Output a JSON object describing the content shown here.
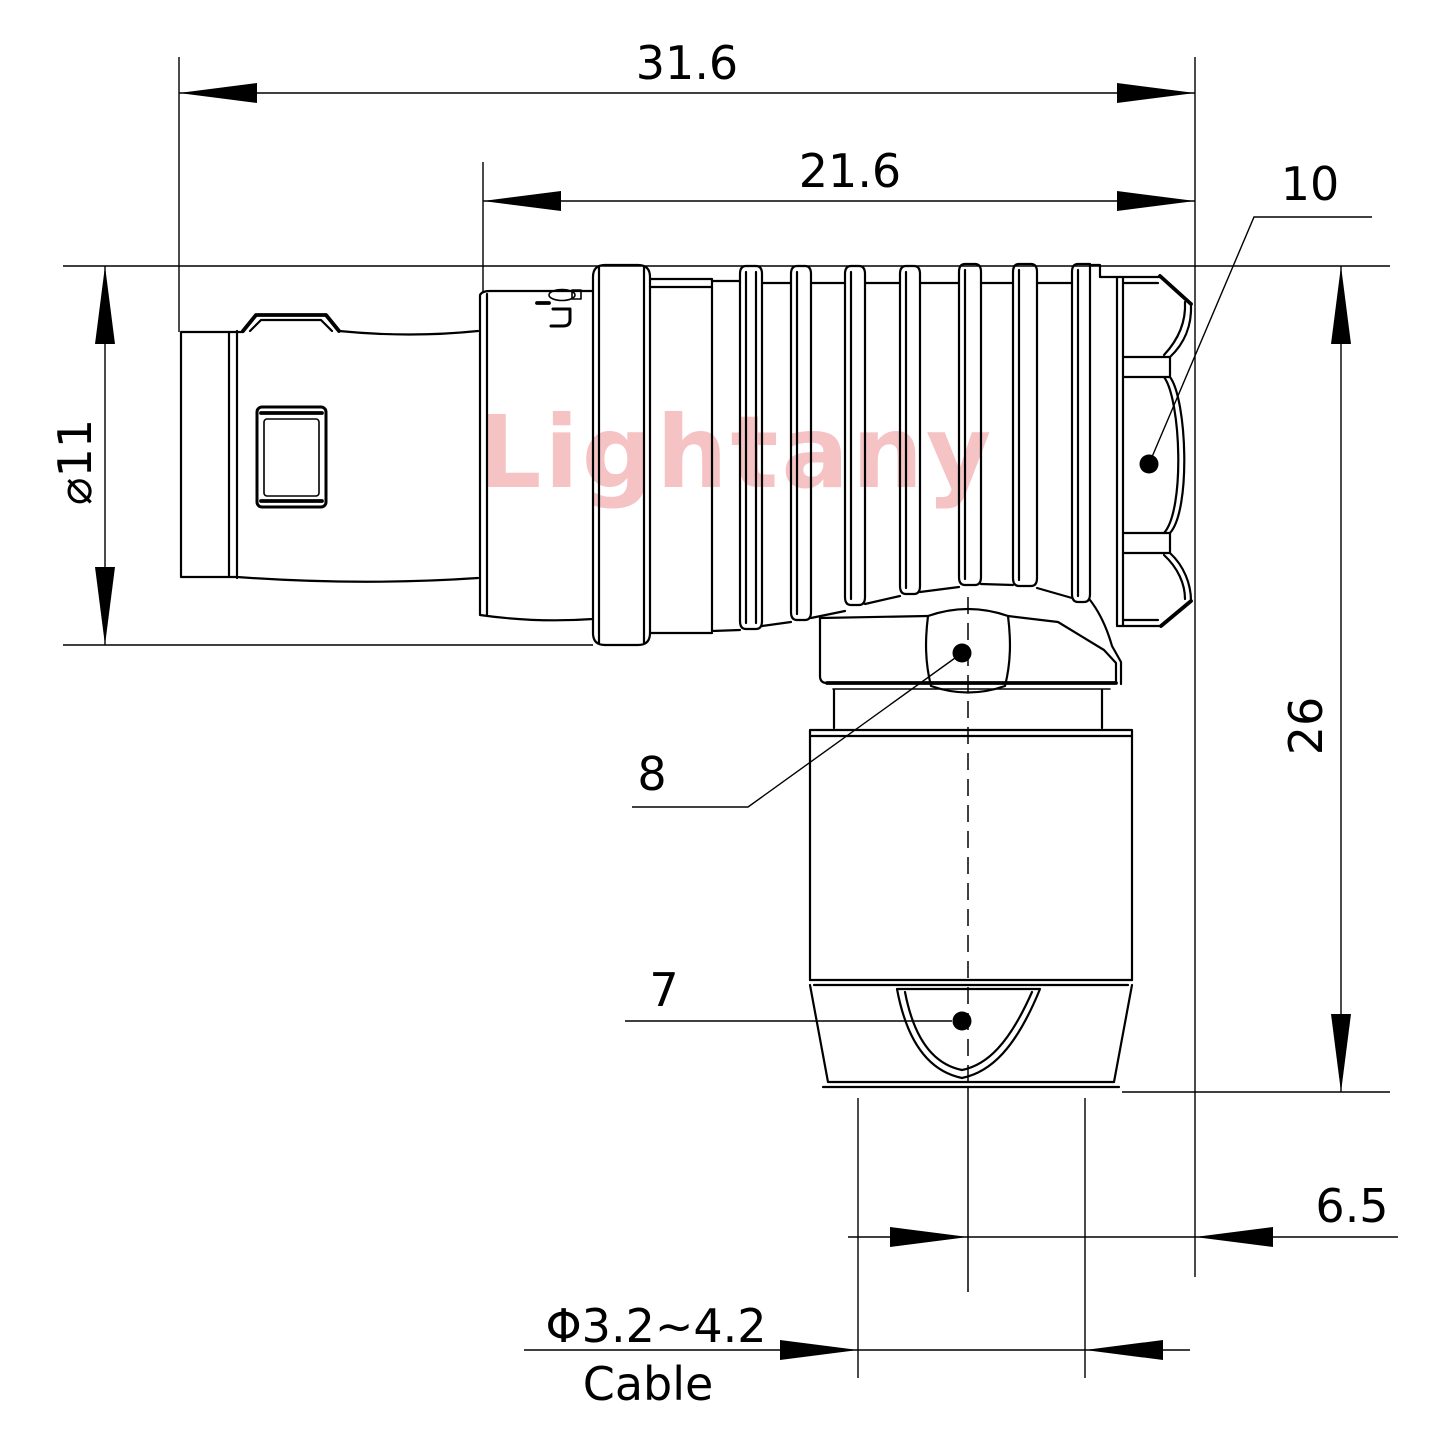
{
  "watermark": {
    "text": "Lightany",
    "color": "#f5c3c3"
  },
  "dimensions": {
    "overall_length": "31.6",
    "housing_length": "21.6",
    "shell_diameter": "⌀11",
    "elbow_height": "26",
    "cable_axis_offset": "6.5",
    "cable_range": "Φ3.2~4.2",
    "cable_caption": "Cable"
  },
  "callouts": {
    "coupling_nut": "10",
    "clamp_nut": "8",
    "strain_relief": "7"
  },
  "colors": {
    "line": "#000000",
    "background": "#ffffff",
    "watermark": "#f5c3c3"
  }
}
